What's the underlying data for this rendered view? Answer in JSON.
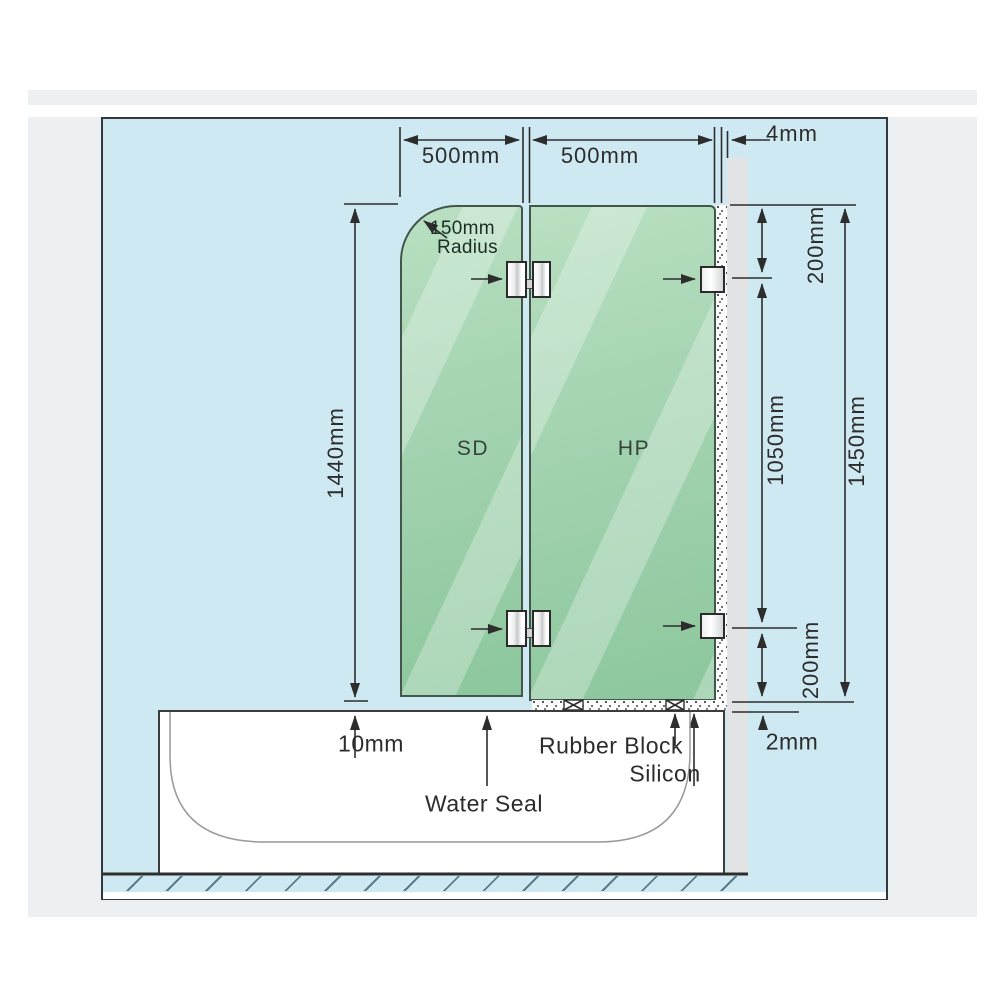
{
  "dimensions": {
    "sd_width": "500mm",
    "hp_width": "500mm",
    "wall_gap": "4mm",
    "corner_radius_line1": "150mm",
    "corner_radius_line2": "Radius",
    "sd_height": "1440mm",
    "top_hinge_offset": "200mm",
    "hinge_spacing": "1050mm",
    "hp_total_height": "1450mm",
    "bottom_hinge_offset": "200mm",
    "bottom_gap": "10mm",
    "tub_edge_gap": "2mm"
  },
  "labels": {
    "left_panel": "SD",
    "right_panel": "HP",
    "water_seal": "Water Seal",
    "rubber_block": "Rubber Block",
    "silicon": "Silicon"
  },
  "colors": {
    "diagram_background": "#cfe9f3",
    "glass_green": "#9ccfa9",
    "wall_gray": "#e2e3e4",
    "line_color": "#2d2d2d"
  }
}
